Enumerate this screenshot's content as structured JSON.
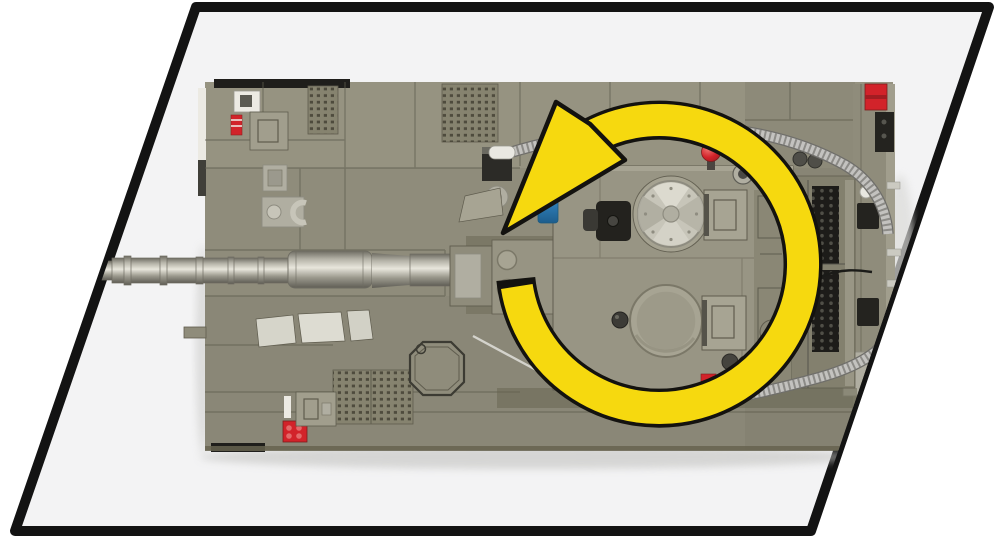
{
  "figure": {
    "kind": "product-illustration",
    "subject": "toy-brick-tank-top-view",
    "annotation": "turret-rotation-arrow-counterclockwise"
  },
  "palette": {
    "frame": "#131313",
    "page_bg": "#ffffff",
    "panel_bg": "#f3f3f4",
    "hull": "#8f8c7b",
    "hull_light": "#a19e8d",
    "hull_dark": "#7b7868",
    "hull_shadow": "#66634f",
    "line": "#5f5c4e",
    "turret": "#999685",
    "turret_light": "#a7a493",
    "metal": "#c7c5b9",
    "metal_mid": "#b0aea1",
    "metal_dark": "#8e8c80",
    "barrel_hi": "#e8e6dc",
    "barrel_dark": "#6e6c62",
    "near_black": "#23221e",
    "white_part": "#eceae3",
    "red": "#d2232a",
    "blue": "#2e7cb5",
    "blue_light": "#7cc4e0",
    "yellow": "#f6d90f",
    "arrow_outline": "#13120f",
    "cable": "#c3c2bf",
    "cable_rib": "#8c8b87",
    "cable_edge": "#6f6e6a",
    "holes": "#4e4b3d",
    "shadow": "#c2c2c0"
  }
}
